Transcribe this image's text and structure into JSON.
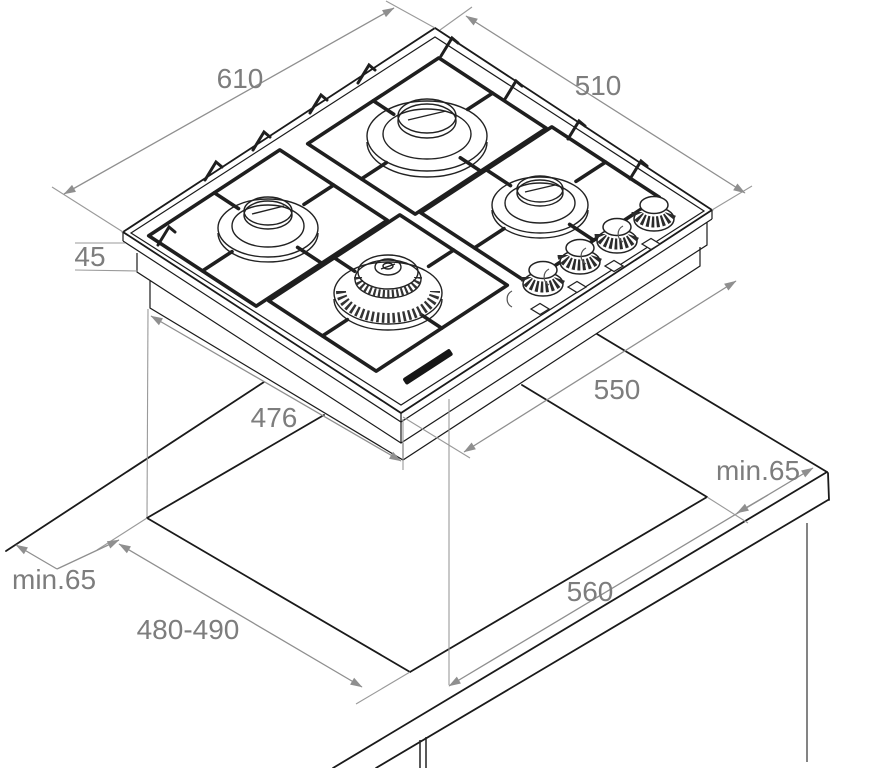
{
  "diagram": {
    "kind": "built-in gas hob installation drawing, 4 burners, isometric view",
    "dimensions": {
      "hob_width": "610",
      "hob_depth": "510",
      "hob_height": "45",
      "base_width": "476",
      "base_depth": "550",
      "cutout_width": "560",
      "cutout_depth": "480-490",
      "clearance_left": "min.65",
      "clearance_right": "min.65"
    }
  }
}
